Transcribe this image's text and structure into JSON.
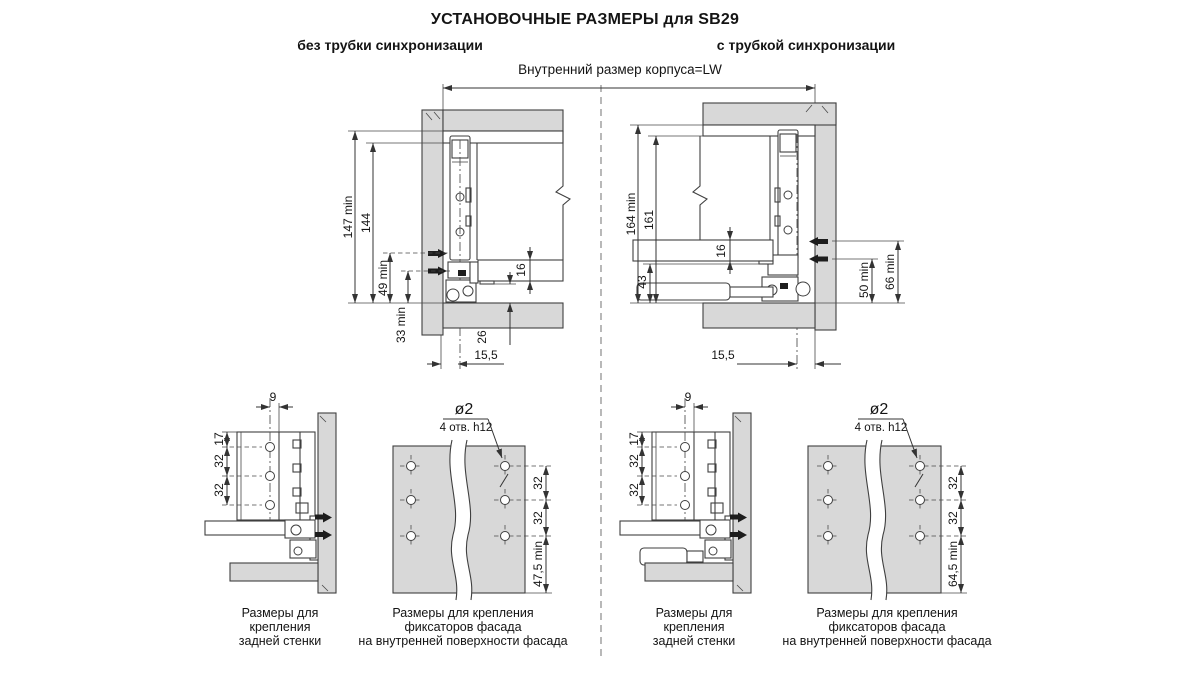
{
  "page": {
    "title": "УСТАНОВОЧНЫЕ РАЗМЕРЫ для SB29"
  },
  "headers": {
    "left": "без трубки синхронизации",
    "right": "с трубкой синхронизации",
    "cabinet_width": "Внутренний размер корпуса=LW"
  },
  "top_left": {
    "dims": {
      "height_min": "147 min",
      "height": "144",
      "screw_min": "49 min",
      "bottom_min": "33 min",
      "panel_thickness": "16",
      "clearance": "26",
      "side_offset": "15,5"
    }
  },
  "top_right": {
    "dims": {
      "height_min": "164 min",
      "height": "161",
      "panel_thickness": "16",
      "clearance": "43",
      "screw_low_min": "50 min",
      "screw_high_min": "66 min",
      "side_offset": "15,5"
    }
  },
  "back_wall": {
    "dims": {
      "hole_offset": "9",
      "top_offset": "17",
      "hole_pitch": "32"
    }
  },
  "facade_plate": {
    "hole_dia": "ø2",
    "holes_note": "4 отв. h12",
    "hole_pitch": "32",
    "bottom_min_left": "47,5 min",
    "bottom_min_right": "64,5 min"
  },
  "captions": {
    "back_wall": [
      "Размеры для",
      "крепления",
      "задней стенки"
    ],
    "facade": [
      "Размеры для крепления",
      "фиксаторов фасада",
      "на внутренней поверхности фасада"
    ]
  },
  "colors": {
    "panel_gray": "#d8d8d8",
    "line": "#3c3c3c",
    "text": "#1b1b1b"
  }
}
